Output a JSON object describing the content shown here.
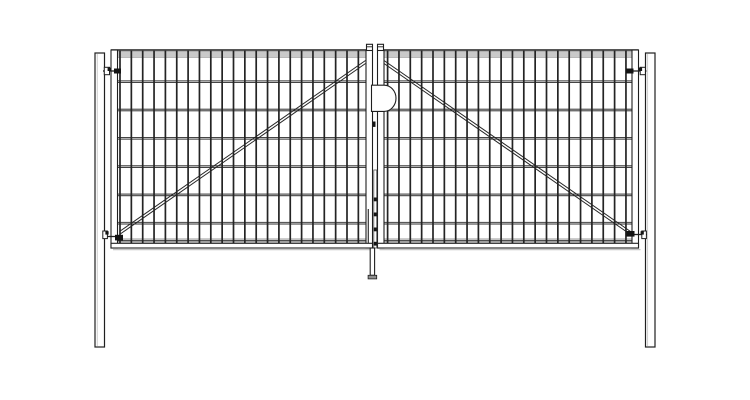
{
  "drawing": {
    "title": "double-leaf-wire-mesh-swing-gate-front-elevation",
    "canvas": {
      "width": 750,
      "height": 400,
      "background": "#ffffff"
    },
    "colors": {
      "outline": "#1f1f1f",
      "wire": "#242424",
      "wire_dark": "#2e2e2e",
      "wire_highlight": "#d9d9d9",
      "band_fill": "#c9c9c9",
      "band_edge": "#9b9b9b",
      "hardware_dark": "#141414",
      "shadow": "#c5c5c5",
      "white": "#ffffff",
      "foot_fill": "#909090"
    },
    "posts": {
      "left": {
        "x": 95,
        "y": 53,
        "w": 9.5,
        "h": 294
      },
      "right": {
        "x": 645.5,
        "y": 53,
        "w": 9.5,
        "h": 294
      }
    },
    "leaves": {
      "top": 50,
      "bottom": 248,
      "frame_w": 6.5,
      "top_line_w": 1.4,
      "top_band": {
        "y": 51.4,
        "h": 6.1
      },
      "bottom_band": {
        "y": 238.8,
        "h": 4.5,
        "dark_line_y": 240.8
      },
      "bottom_tube": {
        "y": 243.3,
        "h": 4.7
      },
      "shadow_y": 249.6,
      "horizontal_wire_ys": [
        81.7,
        110,
        138.3,
        166.6,
        194.9,
        223.2
      ],
      "vertical_wire": {
        "y1": 50.7,
        "y2": 243.2,
        "width": 1.7
      },
      "left": {
        "x1": 111,
        "x2": 372.5,
        "mesh_x1": 117.5,
        "mesh_x2": 366,
        "wires": {
          "start": 120,
          "step": 11.35,
          "count": 22
        },
        "diagonal": {
          "x1": 119.5,
          "y1": 231.5,
          "x2": 365.5,
          "y2": 60.5,
          "gap": 3
        }
      },
      "right": {
        "x1": 377.5,
        "x2": 638.5,
        "mesh_x1": 384,
        "mesh_x2": 632,
        "wires": {
          "start": 387.6,
          "step": 11.35,
          "count": 22
        },
        "diagonal": {
          "x1": 384,
          "y1": 60.5,
          "x2": 630.5,
          "y2": 231.5,
          "gap": 3
        }
      },
      "center_stile_caps": [
        {
          "x": 366.5,
          "y": 44.3,
          "w": 6,
          "h": 6.2,
          "cap_line_y": 46.8
        },
        {
          "x": 377.5,
          "y": 44.3,
          "w": 6,
          "h": 6.2,
          "cap_line_y": 46.8
        }
      ]
    },
    "hardware": {
      "hinges": [
        {
          "name": "top-left-hinge",
          "pin": [
            103,
            71,
            15
          ],
          "white_block": [
            104.3,
            67.3,
            5.2,
            7.4
          ],
          "nub": [
            107.6,
            67.6,
            3.2,
            3.4
          ],
          "dark_block": [
            114,
            68.5,
            7,
            5
          ]
        },
        {
          "name": "bottom-left-hinge",
          "pin": [
            102.5,
            236.5,
            15
          ],
          "white_block": [
            102.8,
            231,
            4.6,
            7.6
          ],
          "nub": [
            105.4,
            231.2,
            3.2,
            3.4
          ],
          "dark_block": [
            115,
            234.8,
            8,
            5.6
          ]
        },
        {
          "name": "top-right-hinge",
          "pin": [
            631.5,
            71,
            15
          ],
          "white_block": [
            640.2,
            67.3,
            5.2,
            7.4
          ],
          "nub": [
            638.9,
            67.6,
            3.2,
            3.4
          ],
          "dark_block": [
            626,
            68.5,
            7.5,
            5
          ]
        },
        {
          "name": "bottom-right-hinge",
          "pin": [
            632,
            234.5,
            15
          ],
          "white_block": [
            641.8,
            231,
            4.6,
            7.6
          ],
          "nub": [
            640.6,
            231.2,
            3.2,
            3.4
          ],
          "dark_block": [
            626.3,
            231,
            8.2,
            5.6
          ]
        }
      ],
      "lock": {
        "x": 371.5,
        "y": 85.2,
        "flat_w": 12.5,
        "h": 26.2,
        "rx": 12,
        "ry": 13.1
      },
      "lock_bolt": {
        "x": 372.9,
        "y": 121.5,
        "w": 2.6,
        "h": 5.4
      },
      "latch_shaft": {
        "x": 373.8,
        "y": 170,
        "w": 2.9,
        "h": 78
      },
      "latch_marks": {
        "x": 373.5,
        "w": 3.4,
        "h": 3.8,
        "ys": [
          197.5,
          212.5,
          227.5,
          241.8
        ]
      },
      "guide_rod": {
        "x": 368.3,
        "y1": 209,
        "y2": 243
      },
      "drop_rod": {
        "x": 370.2,
        "y": 248,
        "w": 4.4,
        "h": 27.3
      },
      "drop_rod_foot": {
        "x": 368.1,
        "y": 275.3,
        "w": 8.6,
        "h": 3.6
      }
    }
  }
}
